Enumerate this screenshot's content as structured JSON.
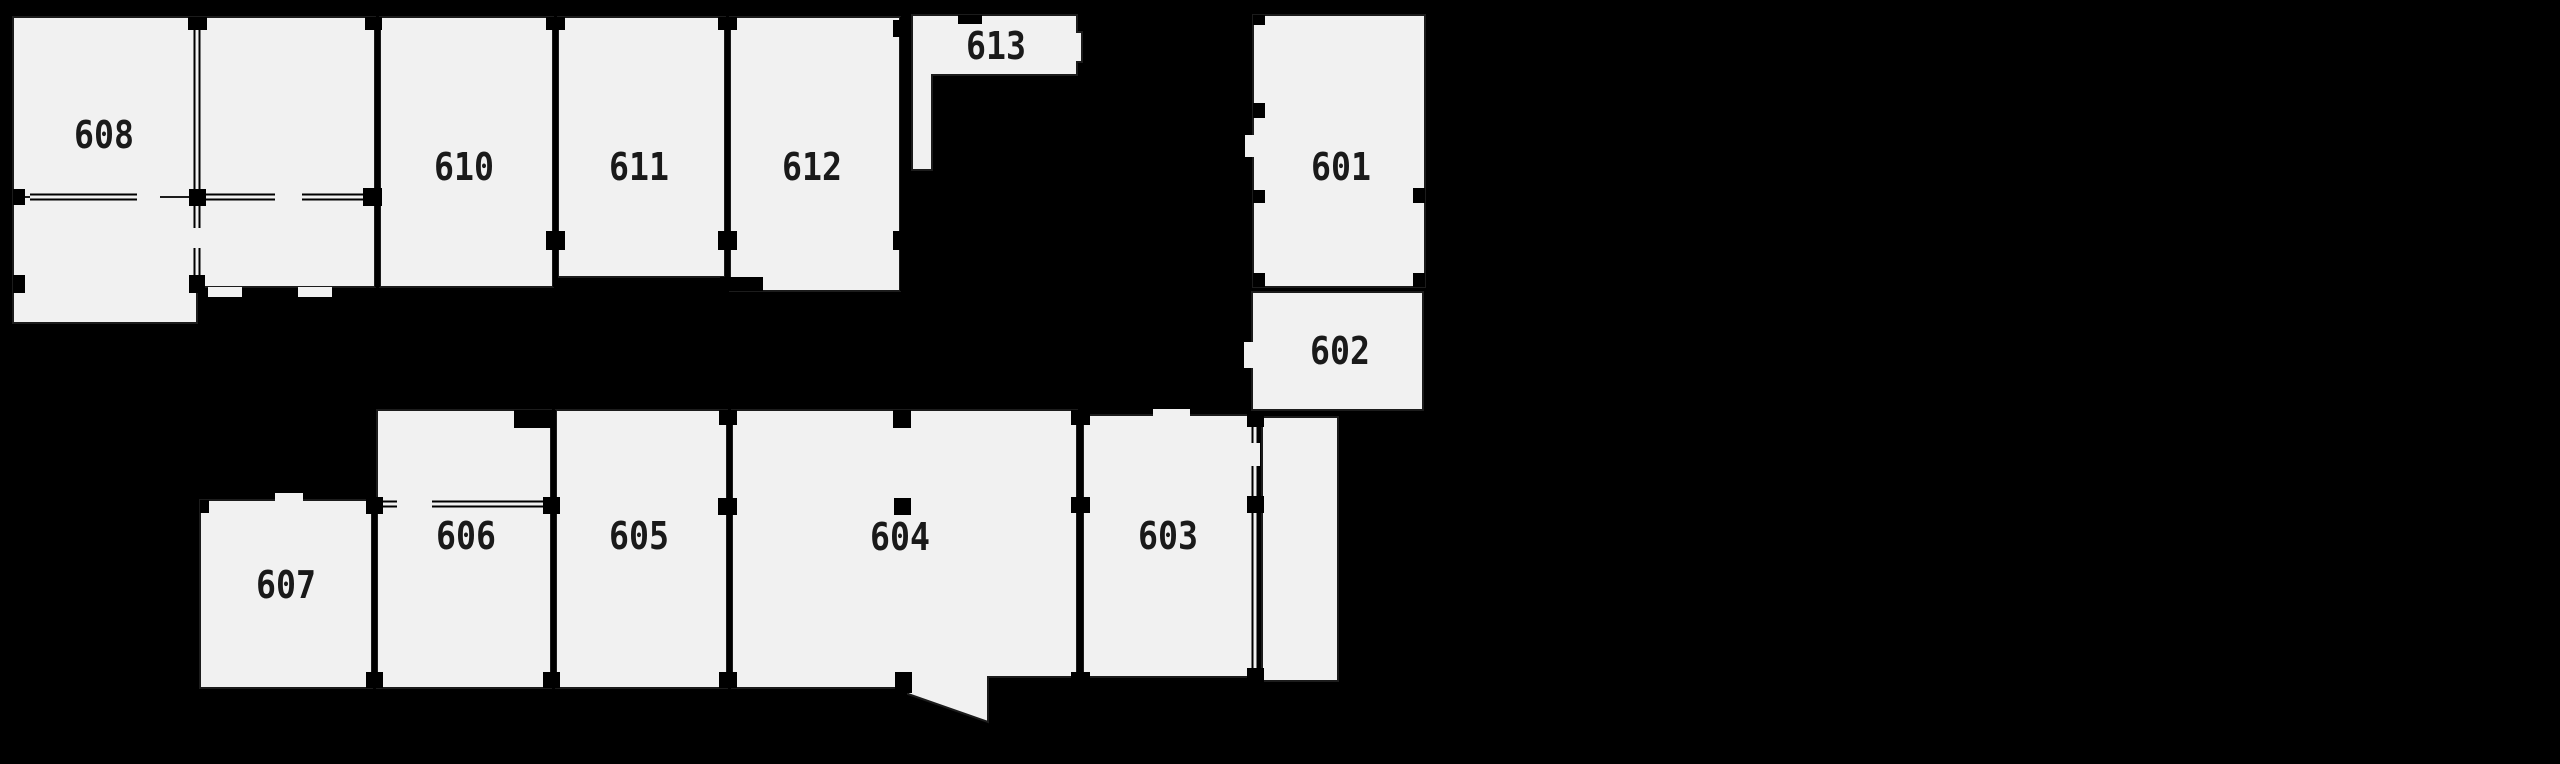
{
  "canvas": {
    "width": 2560,
    "height": 764,
    "background": "#000000"
  },
  "style": {
    "room_fill": "#f1f1f1",
    "line_color": "#1c1c1c",
    "wall_color": "#000000",
    "label_color": "#1a1a1a",
    "label_font_size": 38,
    "label_char_width": 20,
    "room_stroke_width": 2
  },
  "rooms": [
    {
      "id": "608",
      "label": "608",
      "shape": "rect",
      "x": 13,
      "y": 17,
      "w": 184,
      "h": 180,
      "lx": 104,
      "ly": 135
    },
    {
      "id": "unit-a",
      "label": "",
      "shape": "rect",
      "x": 197,
      "y": 17,
      "w": 178,
      "h": 270,
      "lx": 0,
      "ly": 0
    },
    {
      "id": "unit-b",
      "label": "",
      "shape": "rect",
      "x": 13,
      "y": 197,
      "w": 184,
      "h": 126,
      "lx": 0,
      "ly": 0
    },
    {
      "id": "610",
      "label": "610",
      "shape": "rect",
      "x": 380,
      "y": 17,
      "w": 173,
      "h": 270,
      "lx": 464,
      "ly": 167
    },
    {
      "id": "611",
      "label": "611",
      "shape": "rect",
      "x": 558,
      "y": 17,
      "w": 167,
      "h": 260,
      "lx": 639,
      "ly": 167
    },
    {
      "id": "612",
      "label": "612",
      "shape": "rect",
      "x": 730,
      "y": 17,
      "w": 170,
      "h": 274,
      "lx": 812,
      "ly": 167
    },
    {
      "id": "613",
      "label": "613",
      "shape": "polygon",
      "points": [
        [
          912,
          15
        ],
        [
          1077,
          15
        ],
        [
          1077,
          32
        ],
        [
          1082,
          32
        ],
        [
          1082,
          62
        ],
        [
          1077,
          62
        ],
        [
          1077,
          75
        ],
        [
          932,
          75
        ],
        [
          932,
          170
        ],
        [
          912,
          170
        ]
      ],
      "lx": 996,
      "ly": 46
    },
    {
      "id": "601",
      "label": "601",
      "shape": "rect",
      "x": 1253,
      "y": 15,
      "w": 172,
      "h": 272,
      "lx": 1341,
      "ly": 167
    },
    {
      "id": "602",
      "label": "602",
      "shape": "rect",
      "x": 1252,
      "y": 292,
      "w": 171,
      "h": 118,
      "lx": 1340,
      "ly": 351
    },
    {
      "id": "607",
      "label": "607",
      "shape": "rect",
      "x": 200,
      "y": 500,
      "w": 172,
      "h": 188,
      "lx": 286,
      "ly": 585
    },
    {
      "id": "606",
      "label": "606",
      "shape": "rect",
      "x": 377,
      "y": 410,
      "w": 174,
      "h": 278,
      "lx": 466,
      "ly": 536
    },
    {
      "id": "605",
      "label": "605",
      "shape": "rect",
      "x": 556,
      "y": 410,
      "w": 171,
      "h": 278,
      "lx": 639,
      "ly": 536
    },
    {
      "id": "604",
      "label": "604",
      "shape": "polygon",
      "points": [
        [
          732,
          410
        ],
        [
          1077,
          410
        ],
        [
          1077,
          677
        ],
        [
          988,
          677
        ],
        [
          988,
          722
        ],
        [
          908,
          694
        ],
        [
          908,
          688
        ],
        [
          732,
          688
        ]
      ],
      "lx": 900,
      "ly": 537
    },
    {
      "id": "603",
      "label": "603",
      "shape": "rect",
      "x": 1083,
      "y": 415,
      "w": 170,
      "h": 262,
      "lx": 1168,
      "ly": 536
    },
    {
      "id": "unit-c",
      "label": "",
      "shape": "rect",
      "x": 1262,
      "y": 417,
      "w": 76,
      "h": 264,
      "lx": 0,
      "ly": 0
    }
  ],
  "thick_walls": [
    {
      "x": 375,
      "y": 17,
      "w": 5,
      "h": 270
    },
    {
      "x": 553,
      "y": 17,
      "w": 5,
      "h": 270
    },
    {
      "x": 725,
      "y": 17,
      "w": 5,
      "h": 274
    },
    {
      "x": 900,
      "y": 17,
      "w": 5,
      "h": 274
    },
    {
      "x": 372,
      "y": 500,
      "w": 5,
      "h": 188
    },
    {
      "x": 551,
      "y": 410,
      "w": 5,
      "h": 278
    },
    {
      "x": 727,
      "y": 410,
      "w": 5,
      "h": 278
    },
    {
      "x": 1077,
      "y": 410,
      "w": 6,
      "h": 278
    }
  ],
  "thin_walls": [
    {
      "o": "h",
      "x": 30,
      "y": 197,
      "len": 107
    },
    {
      "o": "h",
      "x": 205,
      "y": 197,
      "len": 70
    },
    {
      "o": "h",
      "x": 302,
      "y": 197,
      "len": 63
    },
    {
      "o": "v",
      "x": 197,
      "y": 17,
      "len": 180
    },
    {
      "o": "v",
      "x": 197,
      "y": 205,
      "len": 23
    },
    {
      "o": "v",
      "x": 197,
      "y": 248,
      "len": 30
    },
    {
      "o": "h",
      "x": 432,
      "y": 504,
      "len": 111
    },
    {
      "o": "h",
      "x": 380,
      "y": 504,
      "len": 17
    },
    {
      "o": "v",
      "x": 1255,
      "y": 427,
      "len": 16
    },
    {
      "o": "v",
      "x": 1255,
      "y": 466,
      "len": 204
    }
  ],
  "black_marks": [
    {
      "x": 189,
      "y": 189,
      "w": 17,
      "h": 17
    },
    {
      "x": 363,
      "y": 188,
      "w": 19,
      "h": 18
    },
    {
      "x": 189,
      "y": 275,
      "w": 16,
      "h": 18
    },
    {
      "x": 13,
      "y": 189,
      "w": 12,
      "h": 16
    },
    {
      "x": 13,
      "y": 275,
      "w": 12,
      "h": 18
    },
    {
      "x": 546,
      "y": 231,
      "w": 19,
      "h": 19
    },
    {
      "x": 718,
      "y": 231,
      "w": 19,
      "h": 19
    },
    {
      "x": 893,
      "y": 231,
      "w": 17,
      "h": 19
    },
    {
      "x": 188,
      "y": 17,
      "w": 19,
      "h": 13
    },
    {
      "x": 365,
      "y": 17,
      "w": 17,
      "h": 13
    },
    {
      "x": 546,
      "y": 17,
      "w": 19,
      "h": 13
    },
    {
      "x": 718,
      "y": 17,
      "w": 19,
      "h": 13
    },
    {
      "x": 893,
      "y": 20,
      "w": 17,
      "h": 17
    },
    {
      "x": 958,
      "y": 15,
      "w": 24,
      "h": 9
    },
    {
      "x": 720,
      "y": 277,
      "w": 43,
      "h": 14
    },
    {
      "x": 366,
      "y": 497,
      "w": 17,
      "h": 17
    },
    {
      "x": 543,
      "y": 497,
      "w": 17,
      "h": 17
    },
    {
      "x": 718,
      "y": 498,
      "w": 19,
      "h": 17
    },
    {
      "x": 1071,
      "y": 497,
      "w": 19,
      "h": 16
    },
    {
      "x": 1247,
      "y": 496,
      "w": 17,
      "h": 17
    },
    {
      "x": 719,
      "y": 410,
      "w": 18,
      "h": 15
    },
    {
      "x": 1071,
      "y": 410,
      "w": 19,
      "h": 15
    },
    {
      "x": 1247,
      "y": 411,
      "w": 17,
      "h": 16
    },
    {
      "x": 366,
      "y": 672,
      "w": 17,
      "h": 16
    },
    {
      "x": 543,
      "y": 672,
      "w": 17,
      "h": 16
    },
    {
      "x": 719,
      "y": 672,
      "w": 18,
      "h": 16
    },
    {
      "x": 1071,
      "y": 672,
      "w": 19,
      "h": 16
    },
    {
      "x": 1247,
      "y": 668,
      "w": 17,
      "h": 14
    },
    {
      "x": 893,
      "y": 410,
      "w": 18,
      "h": 18
    },
    {
      "x": 894,
      "y": 498,
      "w": 17,
      "h": 17
    },
    {
      "x": 895,
      "y": 672,
      "w": 17,
      "h": 21
    },
    {
      "x": 1253,
      "y": 103,
      "w": 12,
      "h": 15
    },
    {
      "x": 1253,
      "y": 190,
      "w": 12,
      "h": 13
    },
    {
      "x": 1413,
      "y": 188,
      "w": 12,
      "h": 15
    },
    {
      "x": 1253,
      "y": 15,
      "w": 12,
      "h": 10
    },
    {
      "x": 1253,
      "y": 273,
      "w": 12,
      "h": 14
    },
    {
      "x": 1413,
      "y": 273,
      "w": 12,
      "h": 14
    },
    {
      "x": 200,
      "y": 500,
      "w": 9,
      "h": 13
    },
    {
      "x": 514,
      "y": 410,
      "w": 37,
      "h": 18
    }
  ],
  "white_marks": [
    {
      "x": 275,
      "y": 493,
      "w": 28,
      "h": 8
    },
    {
      "x": 1245,
      "y": 135,
      "w": 9,
      "h": 22
    },
    {
      "x": 1244,
      "y": 342,
      "w": 9,
      "h": 26
    },
    {
      "x": 1153,
      "y": 409,
      "w": 37,
      "h": 7
    },
    {
      "x": 208,
      "y": 287,
      "w": 34,
      "h": 10
    },
    {
      "x": 298,
      "y": 287,
      "w": 34,
      "h": 10
    }
  ],
  "erase_marks": [
    {
      "x": 137,
      "y": 192,
      "w": 23,
      "h": 9
    },
    {
      "x": 193,
      "y": 228,
      "w": 8,
      "h": 20
    },
    {
      "x": 1251,
      "y": 443,
      "w": 9,
      "h": 23
    }
  ]
}
